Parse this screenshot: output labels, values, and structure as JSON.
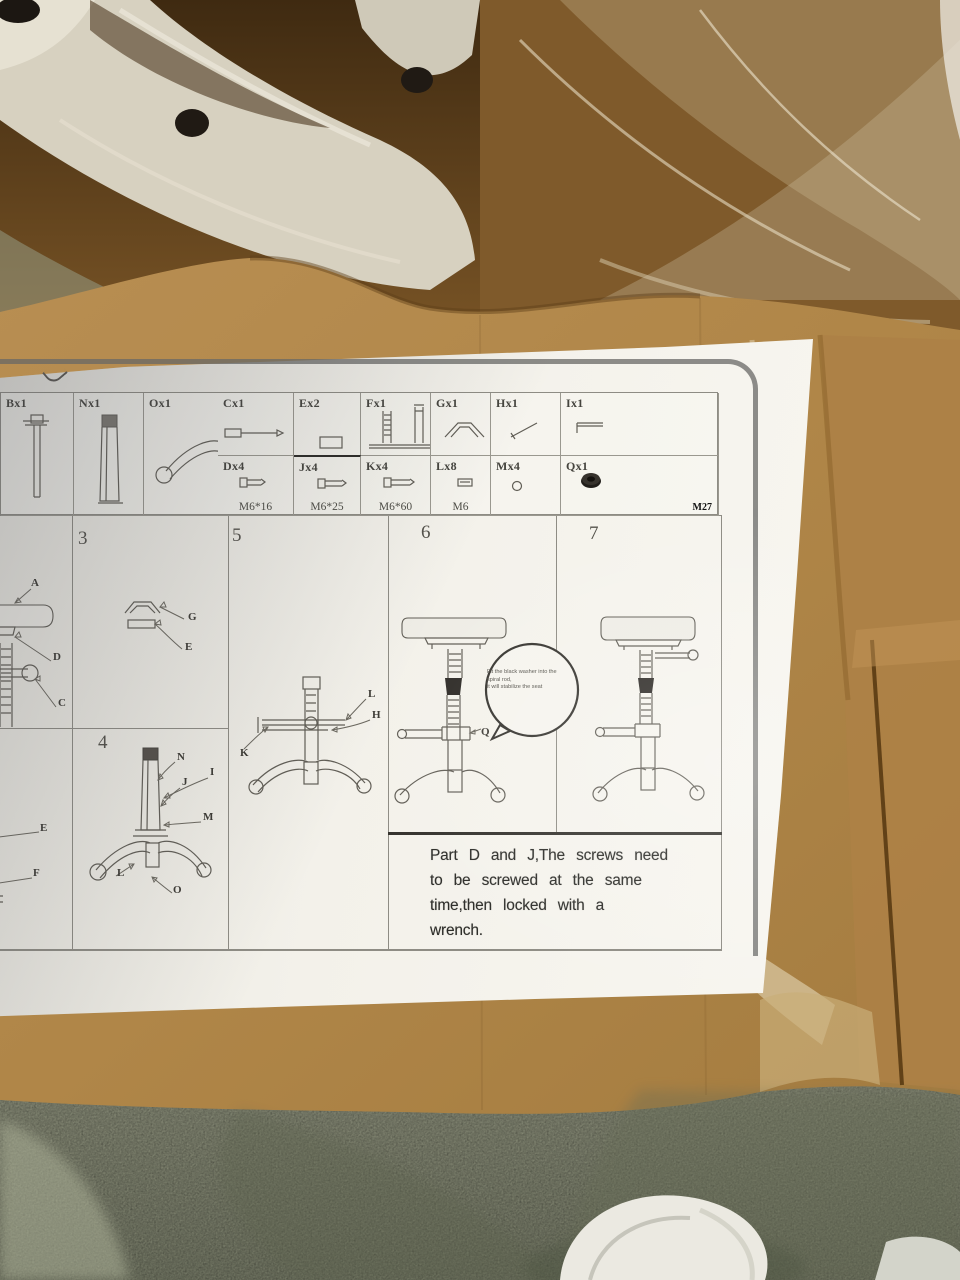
{
  "sheet": {
    "parts": {
      "b": {
        "label": "Bx1"
      },
      "c": {
        "label": "Cx1"
      },
      "e": {
        "label": "Ex2"
      },
      "f": {
        "label": "Fx1"
      },
      "g": {
        "label": "Gx1"
      },
      "h": {
        "label": "Hx1"
      },
      "i": {
        "label": "Ix1"
      },
      "n": {
        "label": "Nx1"
      },
      "o": {
        "label": "Ox1"
      },
      "d": {
        "label": "Dx4",
        "spec": "M6*16"
      },
      "j": {
        "label": "Jx4",
        "spec": "M6*25"
      },
      "k": {
        "label": "Kx4",
        "spec": "M6*60"
      },
      "l": {
        "label": "Lx8",
        "spec": "M6"
      },
      "m": {
        "label": "Mx4"
      },
      "q": {
        "label": "Qx1",
        "spec": "M27"
      }
    },
    "steps": {
      "partial_top": {
        "label_a": "A",
        "label_d": "D",
        "label_c": "C"
      },
      "partial_bottom": {
        "label_e": "E",
        "label_f": "F"
      },
      "s3": {
        "num": "3",
        "label_g": "G",
        "label_e": "E"
      },
      "s4": {
        "num": "4",
        "label_n": "N",
        "label_i": "I",
        "label_j": "J",
        "label_m": "M",
        "label_l": "L",
        "label_o": "O"
      },
      "s5": {
        "num": "5",
        "label_l": "L",
        "label_h": "H",
        "label_k": "K"
      },
      "s6": {
        "num": "6",
        "label_q": "Q",
        "balloon_line1": "Fit the black washer into the",
        "balloon_line2": "spiral rod,",
        "balloon_line3": "it will stabilize the seat"
      },
      "s7": {
        "num": "7"
      }
    },
    "note": {
      "line1": "Part D and J,The screws need",
      "line2": "to be screwed at the same",
      "line3": "time,then locked with a",
      "line4": "wrench."
    }
  }
}
